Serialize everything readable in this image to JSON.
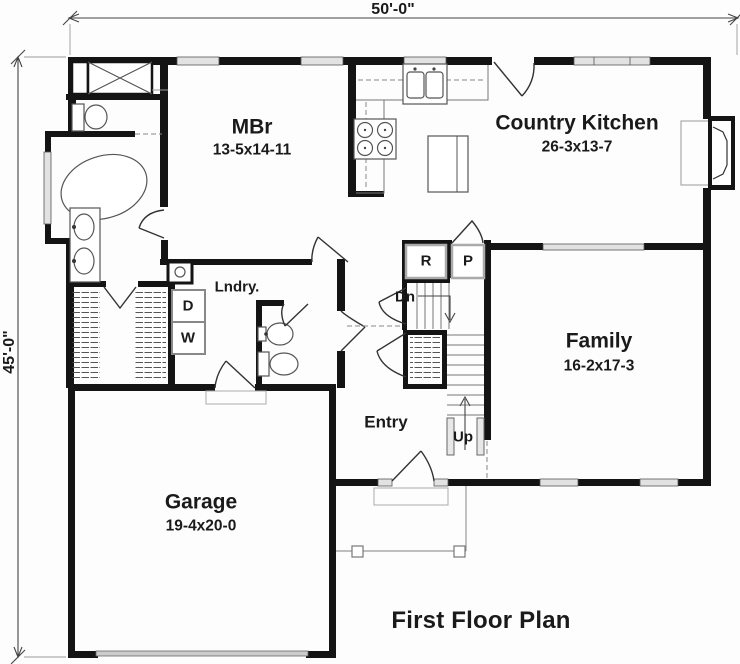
{
  "plan": {
    "title": "First Floor Plan",
    "dim_width": "50'-0\"",
    "dim_height": "45'-0\"",
    "rooms": {
      "mbr": {
        "name": "MBr",
        "size": "13-5x14-11"
      },
      "kitchen": {
        "name": "Country Kitchen",
        "size": "26-3x13-7"
      },
      "family": {
        "name": "Family",
        "size": "16-2x17-3"
      },
      "garage": {
        "name": "Garage",
        "size": "19-4x20-0"
      },
      "entry": {
        "name": "Entry"
      },
      "laundry": {
        "name": "Lndry."
      }
    },
    "fixtures": {
      "refrigerator": "R",
      "pantry": "P",
      "dryer": "D",
      "washer": "W"
    },
    "stairs": {
      "down": "Dn",
      "up": "Up"
    },
    "colors": {
      "walls": "#141414",
      "background": "#ffffff"
    }
  }
}
